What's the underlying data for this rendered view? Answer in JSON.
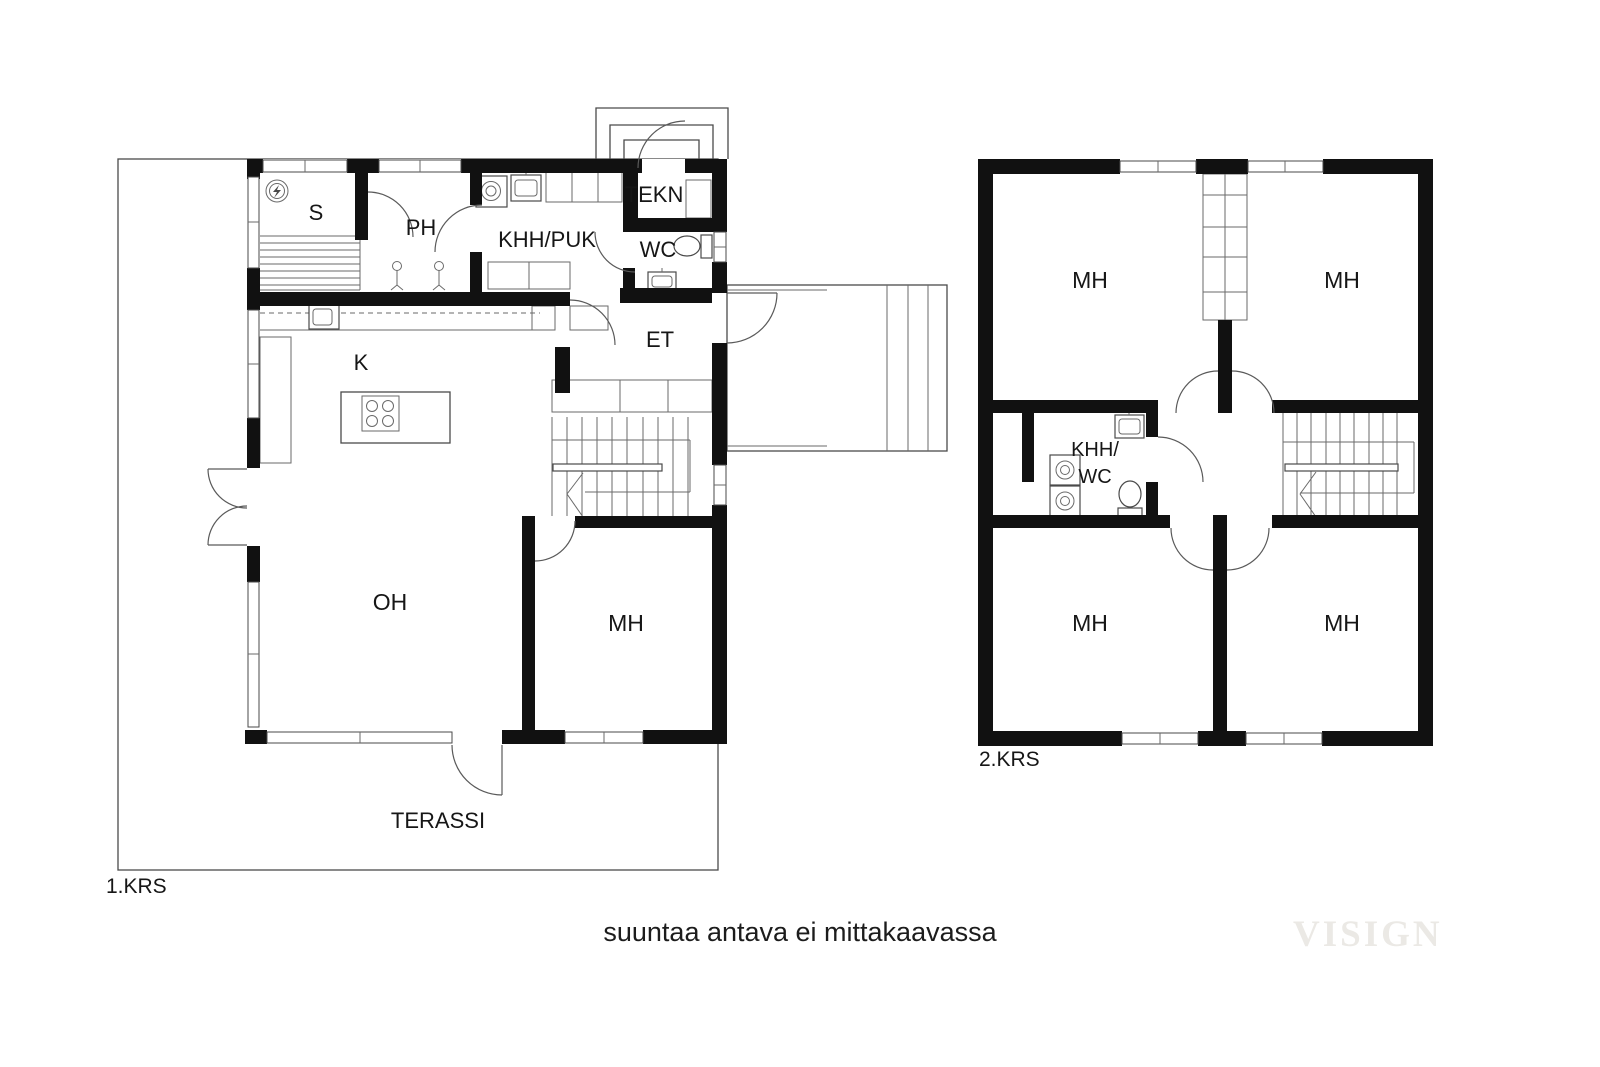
{
  "caption": "suuntaa antava ei mittakaavassa",
  "watermark": "VISIGN",
  "colors": {
    "background": "#ffffff",
    "wall": "#111111",
    "thin_line": "#4a4a4a",
    "label_text": "#161616",
    "watermark_text": "#ebe9e5"
  },
  "icons": {
    "sauna_stove": "electric-sauna-stove-icon",
    "shower": "shower-icon",
    "sink": "sink-icon",
    "toilet": "toilet-icon",
    "washer": "washing-machine-icon",
    "cooktop": "cooktop-icon"
  },
  "floor1": {
    "name": "1.KRS",
    "rooms": {
      "sauna": "S",
      "bathroom": "PH",
      "utility": "KHH/PUK",
      "technical": "TEKN",
      "toilet": "WC",
      "entry": "ET",
      "kitchen": "K",
      "living_room": "OH",
      "bedroom": "MH",
      "terrace": "TERASSI"
    }
  },
  "floor2": {
    "name": "2.KRS",
    "rooms": {
      "bedroom_top_left": "MH",
      "bedroom_top_right": "MH",
      "bedroom_bottom_left": "MH",
      "bedroom_bottom_right": "MH",
      "utility_wc_line1": "KHH/",
      "utility_wc_line2": "WC"
    }
  }
}
